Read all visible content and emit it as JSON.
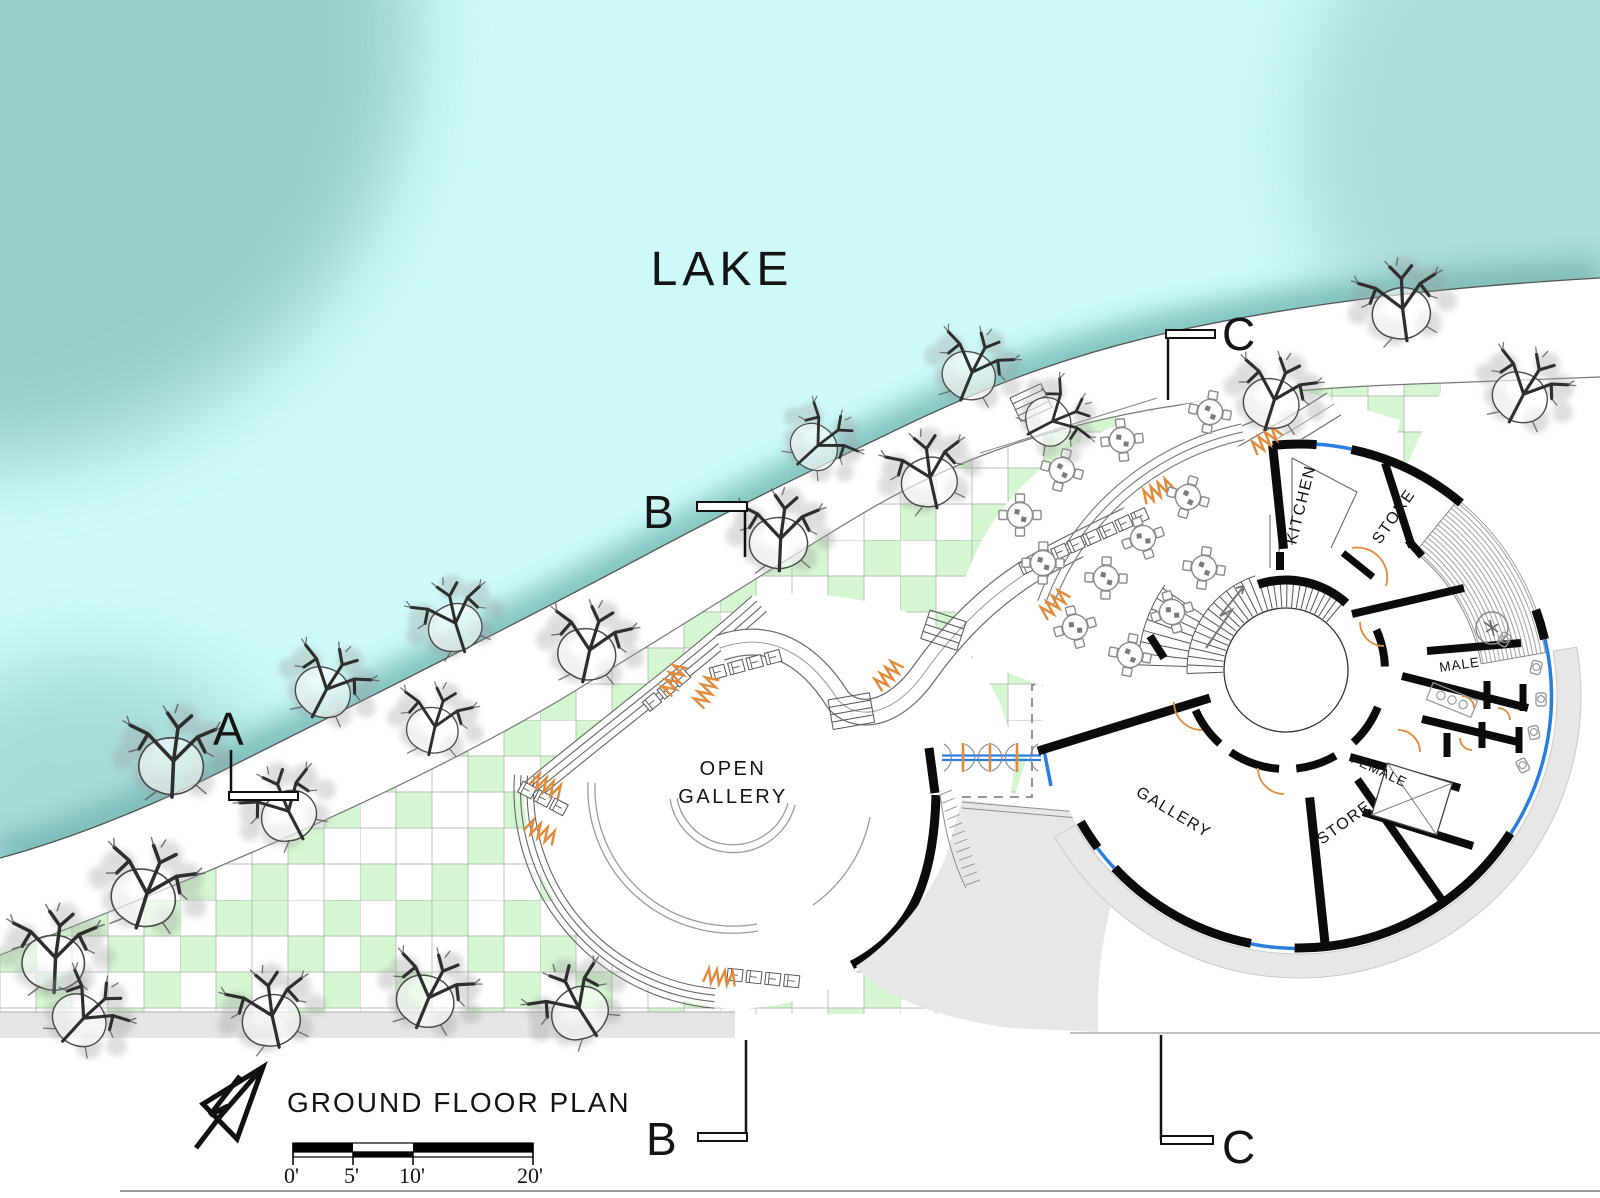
{
  "plan": {
    "lake_label": "LAKE",
    "title": "GROUND FLOOR PLAN",
    "open_gallery": {
      "line1": "OPEN",
      "line2": "GALLERY"
    },
    "rooms": {
      "kitchen": "KITCHEN",
      "store_top": "STORE",
      "male": "MALE",
      "female": "FEMALE",
      "gallery": "GALLERY",
      "store_lower": "STORE"
    },
    "section_markers": {
      "a": "A",
      "b": "B",
      "c": "C"
    },
    "scale_bar": {
      "labels": [
        "0'",
        "5'",
        "10'",
        "20'"
      ]
    },
    "icons": [
      "north-arrow-icon",
      "tree-icon",
      "table-icon",
      "shrub-icon",
      "stair-icon"
    ],
    "colors": {
      "lake": "#cdfaf7",
      "lake_shore": "#7cc0bb",
      "paving_green": "#d4f6d0",
      "terrace_gray": "#e7e7e7",
      "wall_black": "#0b0b0b",
      "glazing_blue": "#2a7de1",
      "door_orange": "#e08b3c",
      "furniture_gray": "#8a8a8a"
    }
  }
}
